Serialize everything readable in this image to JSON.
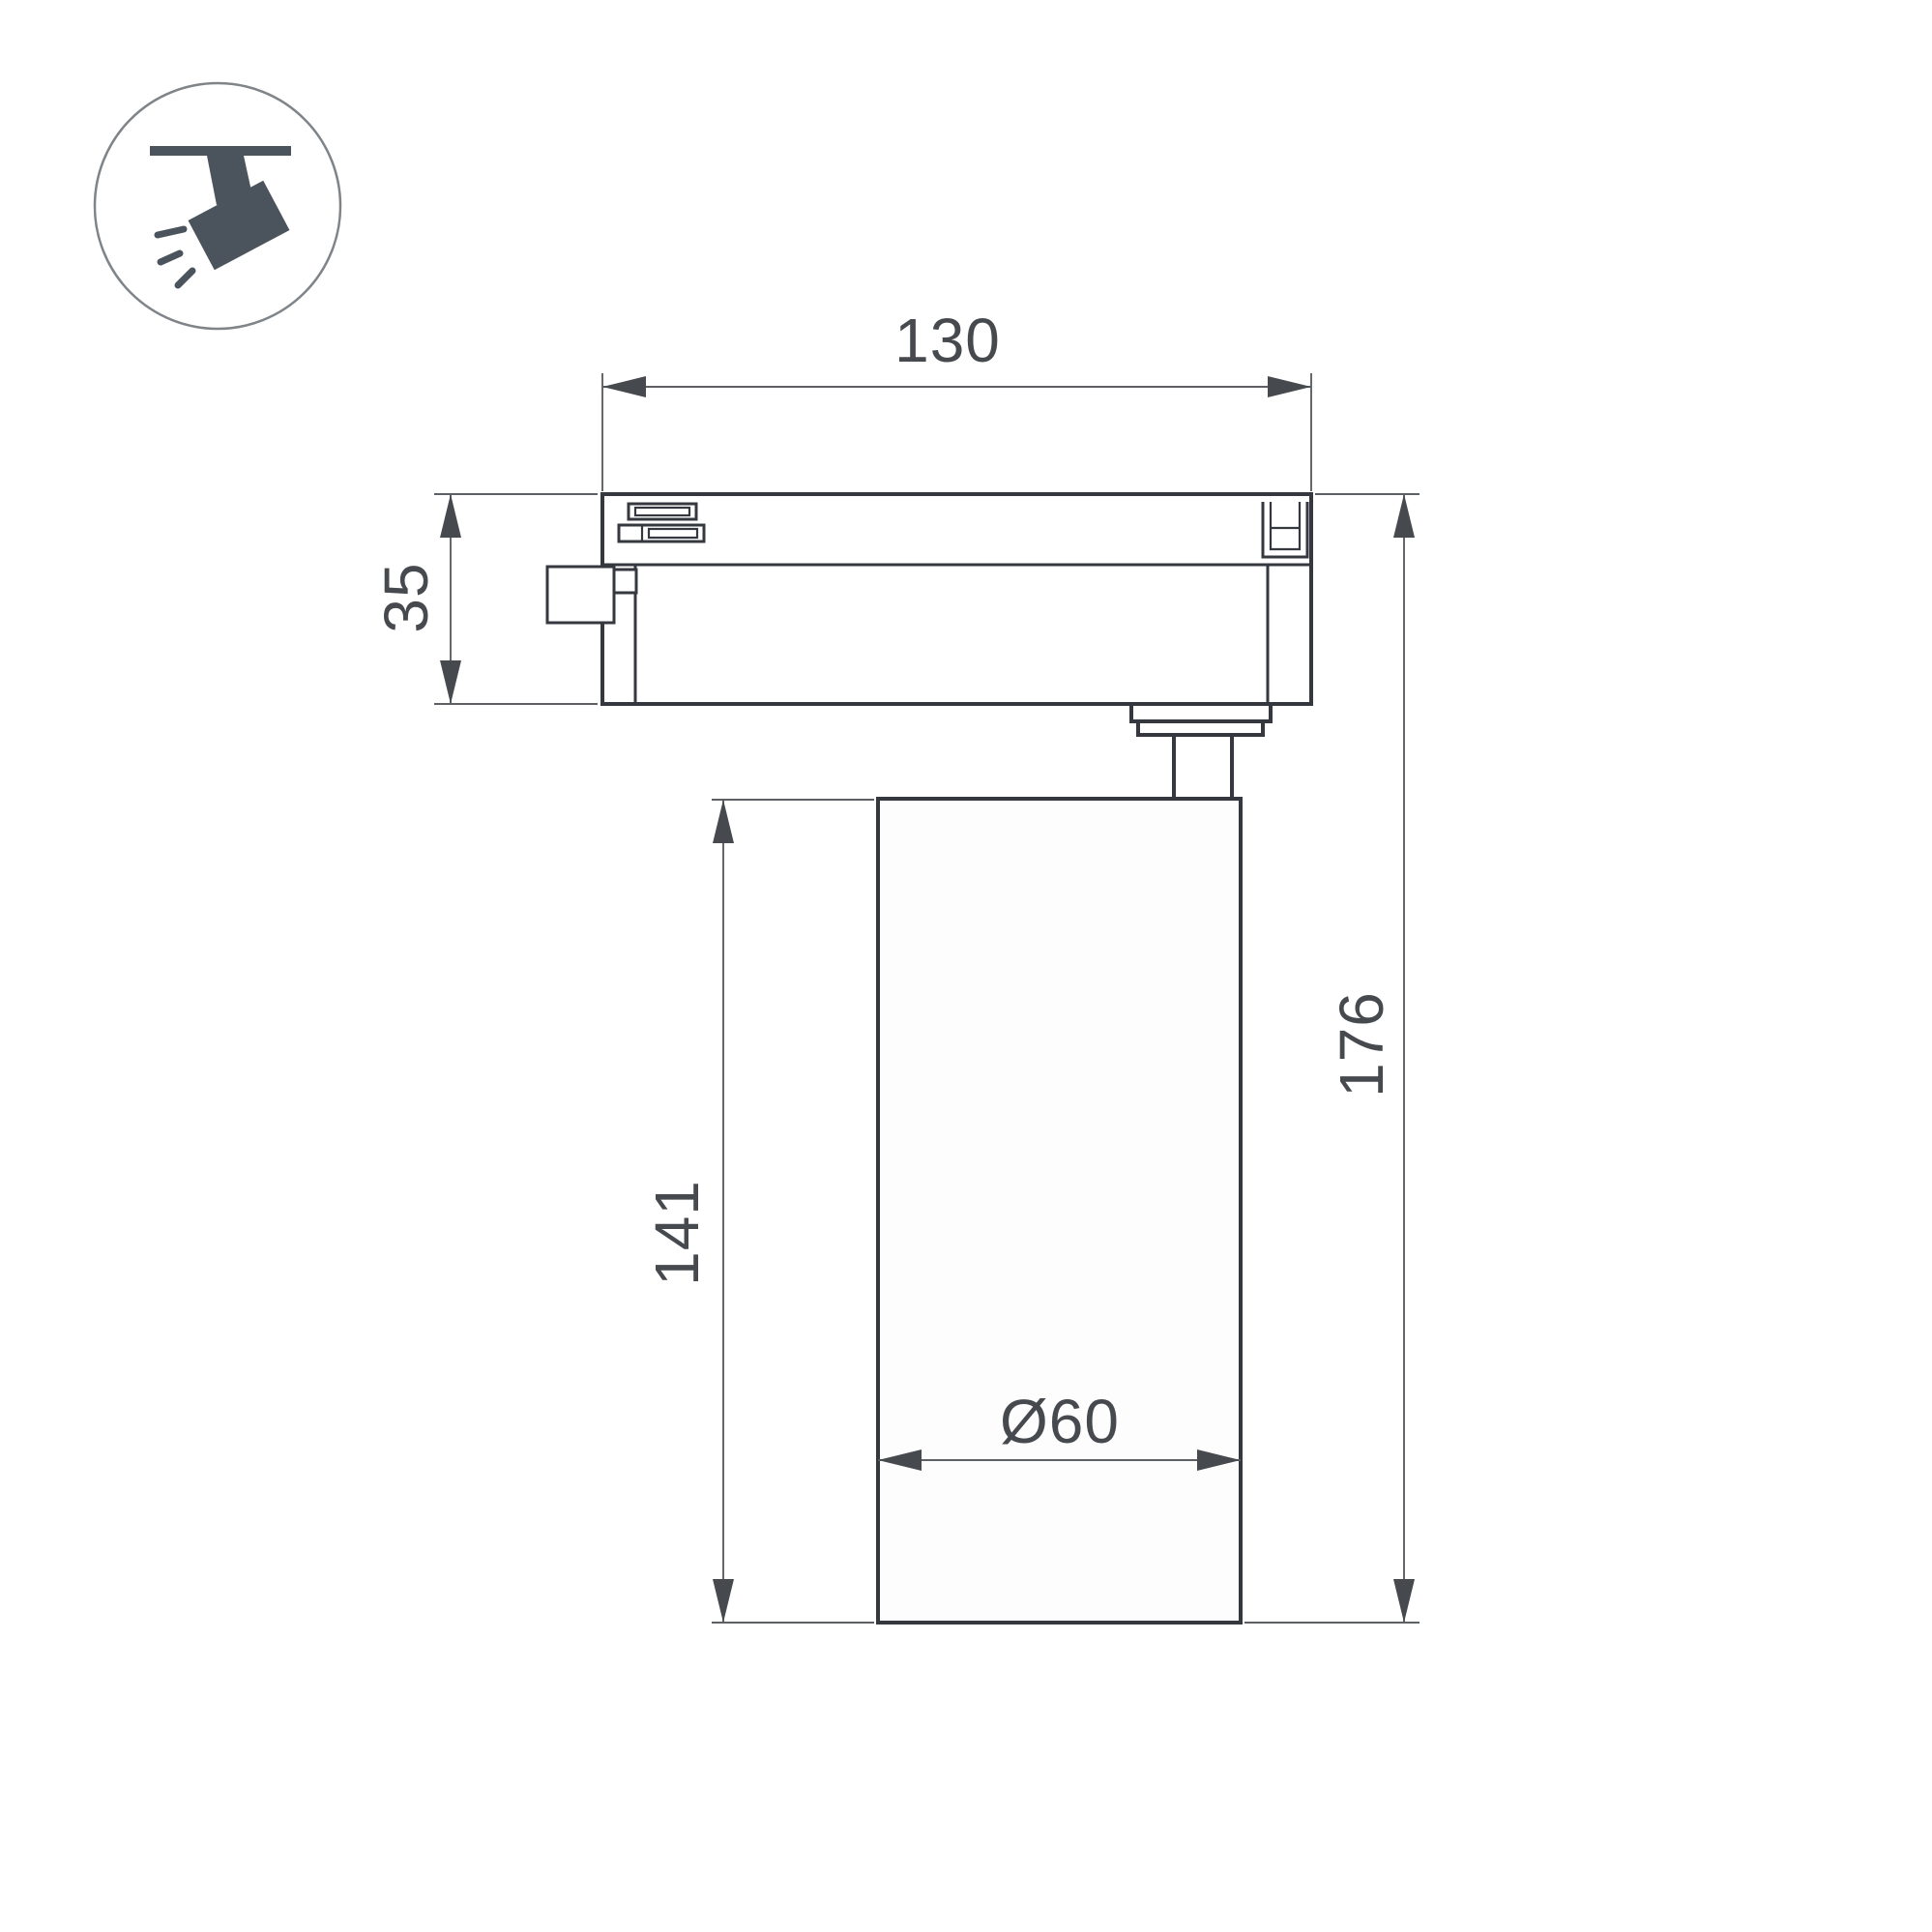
{
  "drawing": {
    "description": "Track spotlight side-view technical dimension drawing",
    "dims": {
      "track_adapter_width": "130",
      "track_adapter_height": "35",
      "lamp_body_height": "141",
      "total_height": "176",
      "lamp_diameter": "Ø60"
    },
    "icon": "ceiling-track-spotlight-icon",
    "colors": {
      "outline": "#35393f",
      "dimension_lines": "#5d6165",
      "text": "#46494e",
      "icon_fill": "#4b545c",
      "icon_circle_stroke": "#7f8489",
      "background": "#ffffff"
    }
  }
}
